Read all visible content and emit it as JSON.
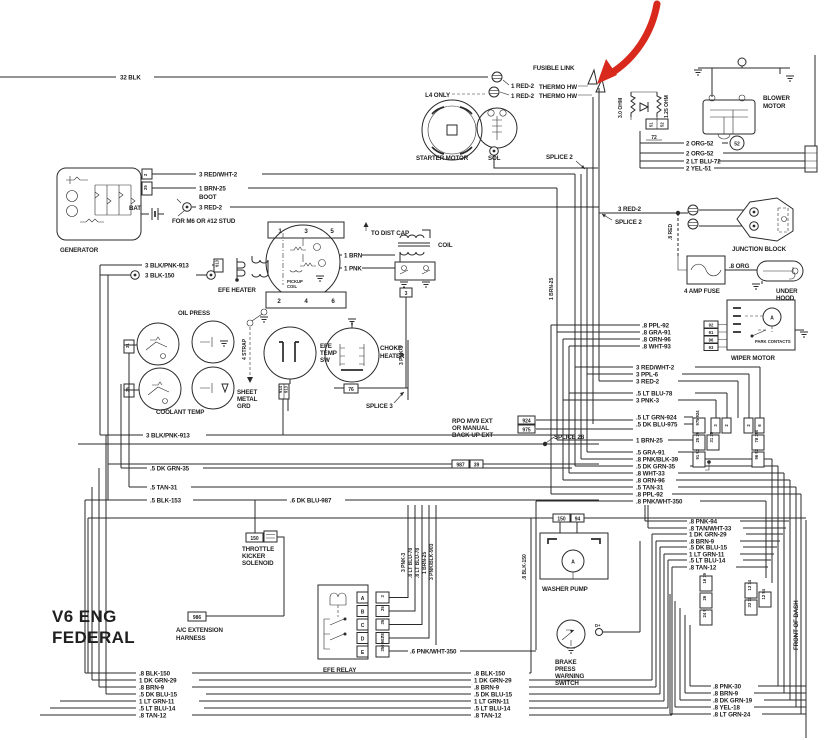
{
  "diagram": {
    "title_line1": "V6 ENG",
    "title_line2": "FEDERAL",
    "front_of_dash": "FRONT OF DASH",
    "annotation_arrow_color": "#d8291c"
  },
  "top_left": {
    "wire": "32 BLK"
  },
  "fusible": {
    "fusible_link": "FUSIBLE LINK",
    "thermo_a": "THERMO HW",
    "thermo_b": "THERMO HW"
  },
  "starter": {
    "l4_only": "L4 ONLY",
    "red2_a": "1 RED-2",
    "red2_b": "1 RED-2",
    "motor": "STARTER MOTOR",
    "sol": "SOL",
    "splice2": "SPLICE 2"
  },
  "blower": {
    "ohm_a": "3.0 OHM",
    "ohm_b": "1.25 OHM",
    "motor_line1": "BLOWER",
    "motor_line2": "MOTOR",
    "conn": [
      "51",
      "52",
      "72"
    ],
    "org52_a": "2 ORG-52",
    "c52": "52",
    "org52_b": "2 ORG-52",
    "ltblu72": "2 LT BLU-72",
    "yel51": "2 YEL-51"
  },
  "generator": {
    "name": "GENERATOR",
    "bat": "BAT",
    "conn2": "2",
    "conn25": "25",
    "redwht2": "3 RED/WHT-2",
    "brn25": "1 BRN-25",
    "boot": "BOOT",
    "red2": "3 RED-2",
    "stud_note": "FOR M6 OR #12 STUD"
  },
  "efe_heater": {
    "blkpnk913": "3 BLK/PNK-913",
    "blk150": "3 BLK-150",
    "conn913": "913",
    "name": "EFE HEATER"
  },
  "distributor": {
    "pins_top": [
      "1",
      "3",
      "5"
    ],
    "pins_bottom": [
      "2",
      "4",
      "6"
    ],
    "pickup_line1": "PICKUP",
    "pickup_line2": "COIL",
    "to_dist_cap": "TO DIST CAP",
    "coil": "COIL",
    "brn1": "1 BRN",
    "pnk1": "1 PNK",
    "conn3": "3",
    "brn25_vert": "1 BRN-25"
  },
  "gauges": {
    "oil_press": "OIL PRESS",
    "coolant_temp": "COOLANT TEMP",
    "strap": "4 STRAP",
    "sheet_line1": "SHEET",
    "sheet_line2": "METAL",
    "sheet_line3": "GRD",
    "conn31": "31",
    "conn35": "35",
    "conn914": "914",
    "conn913": "913",
    "efe_sw_line1": "EFE",
    "efe_sw_line2": "TEMP",
    "efe_sw_line3": "SW",
    "choke_line1": "CHOKE",
    "choke_line2": "HEATER",
    "conn76": "76",
    "splice3": "SPLICE 3",
    "pnk3_vert": "3 PNK-3"
  },
  "left_runs": {
    "blkpnk913": "3 BLK/PNK-913",
    "dkgrn35": ".5 DK GRN-35",
    "tan31": ".5 TAN-31",
    "blk153": ".5 BLK-153",
    "dkblu987": ".6 DK BLU-987",
    "conn150": "150",
    "kicker_line1": "THROTTLE",
    "kicker_line2": "KICKER",
    "kicker_line3": "SOLENOID"
  },
  "junction": {
    "red2": "3 RED-2",
    "splice2": "SPLICE 2",
    "name": "JUNCTION BLOCK",
    "red8": ".8 RED",
    "fuse": "4 AMP FUSE",
    "org8": ".8 ORG",
    "lamp_line1": "UNDER",
    "lamp_line2": "HOOD",
    "lamp_line3": "LAMP"
  },
  "wiper": {
    "labels": [
      ".8 PPL-92",
      ".8 GRA-91",
      ".8 ORN-96",
      ".8 WHT-93"
    ],
    "pins": [
      "92",
      "91",
      "96",
      "93"
    ],
    "name": "WIPER MOTOR",
    "park": "PARK CONTACTS"
  },
  "bus": {
    "rows": [
      "3 RED/WHT-2",
      "3 PPL-6",
      "3 RED-2",
      ".5 LT BLU-78",
      "3 PNK-3",
      ".5 LT GRN-924",
      ".5 DK BLU-975",
      "1 BRN-25",
      ".5 GRA-91",
      ".8 PNK/BLK-39",
      ".5 DK GRN-35",
      ".8 WHT-33",
      ".8 ORN-96",
      ".5 TAN-31",
      ".8 PPL-92",
      ".8 PNK/WHT-350"
    ],
    "rpo_line1": "RPO MV9 EXT",
    "rpo_line2": "OR MANUAL",
    "rpo_line3": "BACK-UP EXT",
    "conn924": "924",
    "conn975": "975",
    "splice28": "SPLICE 28",
    "conn987": "987",
    "conn39": "39",
    "cluster_a": [
      "975 924",
      "3",
      "2",
      "2",
      "6"
    ],
    "cluster_b": [
      "25 39",
      "31 35",
      "78 350"
    ],
    "cluster_c": [
      "91 93",
      "96 92"
    ]
  },
  "efe_relay": {
    "name": "EFE RELAY",
    "pins": [
      "A",
      "B",
      "C",
      "D",
      "E"
    ],
    "pin_nums": [
      "3",
      "25",
      "35",
      "78",
      "350 903"
    ],
    "vwires": [
      "3 PNK-3",
      ".8 LT BLU-78",
      ".8 LT BLU-78",
      "1 BRN-25",
      "3 PNK/BLK-903"
    ],
    "pnkwht350": ".6 PNK/WHT-350"
  },
  "ac_harness": {
    "conn": "986",
    "line1": "A/C EXTENSION",
    "line2": "HARNESS"
  },
  "washer": {
    "name": "WASHER PUMP",
    "conn150": "150",
    "conn94": "94",
    "blk150_vert": ".8 BLK-150",
    "wires": [
      ".8 PNK-94",
      ".8 TAN/WHT-33",
      "1 DK GRN-29",
      ".8 BRN-9",
      ".5 DK BLU-15",
      "1 LT GRN-11",
      ".5 LT BLU-14",
      ".8 TAN-12"
    ],
    "cluster_a": [
      "16 19",
      "26",
      "24 9"
    ],
    "cluster_b": [
      "13 14",
      "33 11",
      "12 94"
    ]
  },
  "brake": {
    "line1": "BRAKE",
    "line2": "PRESS",
    "line3": "WARNING",
    "line4": "SWITCH"
  },
  "bottom": {
    "shared": [
      ".8 BLK-150",
      "1 DK GRN-29",
      ".8 BRN-9",
      ".5 DK BLU-15",
      "1 LT GRN-11",
      ".5 LT BLU-14",
      ".8 TAN-12"
    ],
    "right": [
      ".8 PNK-30",
      ".8 BRN-9",
      ".8 DK GRN-19",
      ".8 YEL-18",
      ".8 LT GRN-24"
    ]
  }
}
